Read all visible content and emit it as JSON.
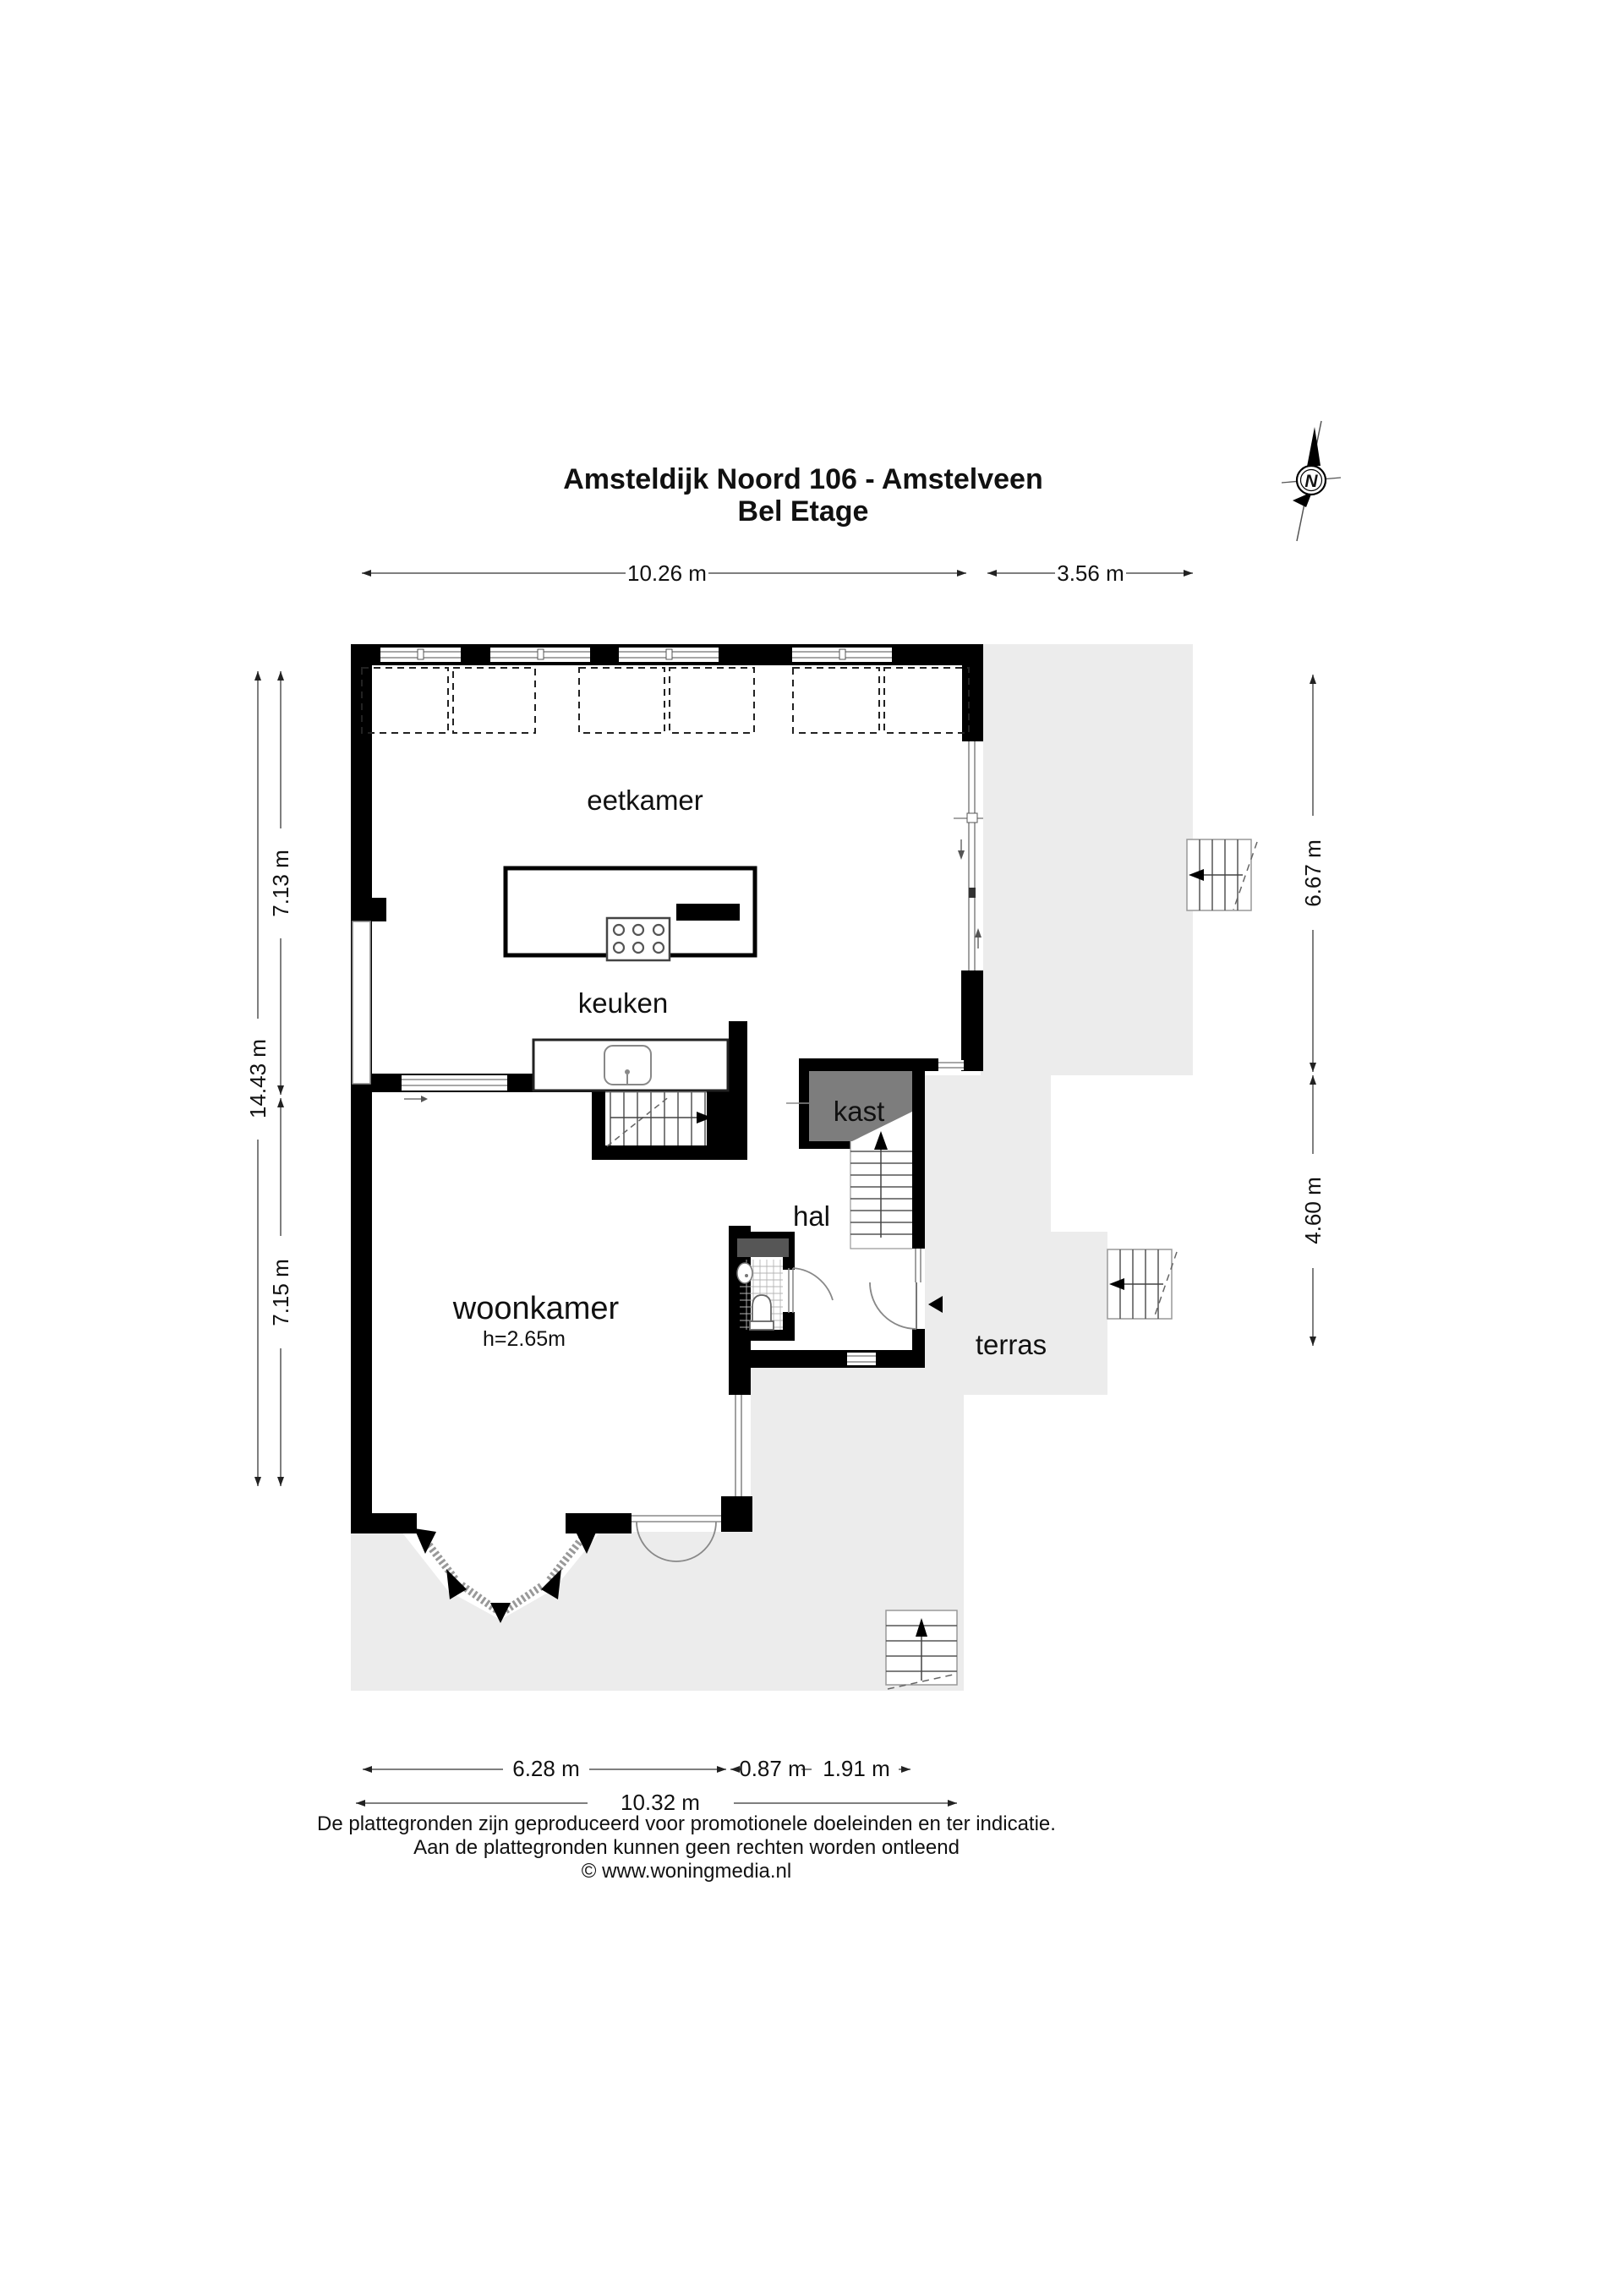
{
  "title": {
    "line1": "Amsteldijk Noord 106 - Amstelveen",
    "line2": "Bel Etage"
  },
  "compass": {
    "label": "N"
  },
  "rooms": {
    "eetkamer": "eetkamer",
    "keuken": "keuken",
    "kast": "kast",
    "hal": "hal",
    "woonkamer": "woonkamer",
    "woonkamer_ceiling_height": "h=2.65m",
    "terras": "terras"
  },
  "dimensions": {
    "top_main": "10.26 m",
    "top_right": "3.56 m",
    "left_upper": "7.13 m",
    "left_total": "14.43 m",
    "left_lower": "7.15 m",
    "right_upper": "6.67 m",
    "right_lower": "4.60 m",
    "bottom_bay": "6.28 m",
    "bottom_door": "0.87 m",
    "bottom_right": "1.91 m",
    "bottom_total": "10.32 m"
  },
  "footer": {
    "line1": "De plattegronden zijn geproduceerd voor promotionele doeleinden en ter indicatie.",
    "line2": "Aan de plattegronden kunnen geen rechten worden ontleend",
    "line3": "© www.woningmedia.nl"
  },
  "colors": {
    "wall": "#000000",
    "terrace": "#ececec",
    "closet": "#7d7d7d",
    "wc_shelf": "#565656"
  }
}
